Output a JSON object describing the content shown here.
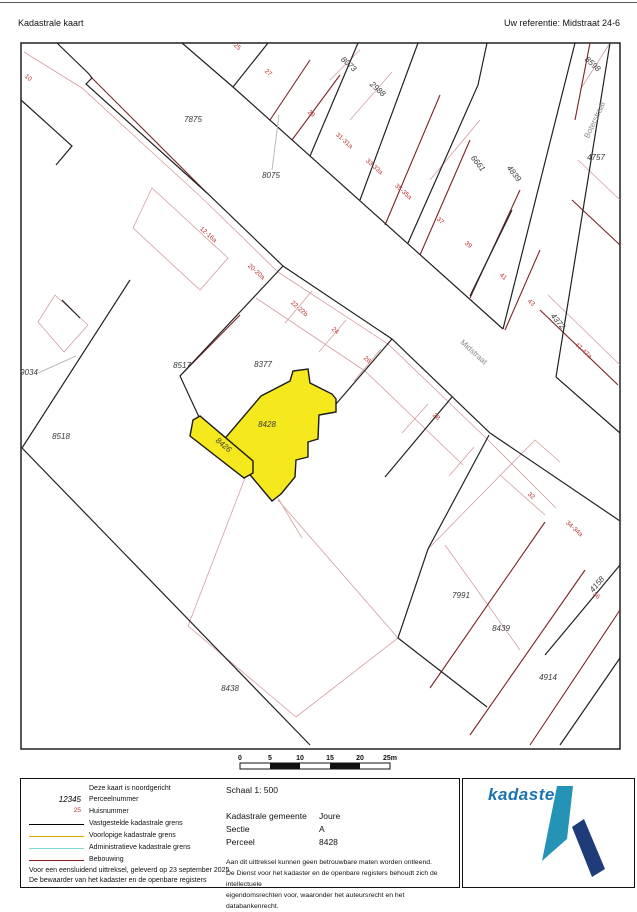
{
  "header": {
    "title": "Kadastrale kaart",
    "reference": "Uw referentie: Midstraat 24-6"
  },
  "map": {
    "highlight_color": "#f5e81c",
    "highlighted_parcel": "8428",
    "parcel_numbers": [
      {
        "t": "7875",
        "x": 193,
        "y": 122,
        "r": 0
      },
      {
        "t": "8075",
        "x": 271,
        "y": 178,
        "r": 0
      },
      {
        "t": "8073",
        "x": 347,
        "y": 66,
        "r": 42
      },
      {
        "t": "2988",
        "x": 376,
        "y": 91,
        "r": 42
      },
      {
        "t": "6661",
        "x": 476,
        "y": 165,
        "r": 52
      },
      {
        "t": "4839",
        "x": 512,
        "y": 175,
        "r": 52
      },
      {
        "t": "8598",
        "x": 591,
        "y": 66,
        "r": 42
      },
      {
        "t": "4757",
        "x": 596,
        "y": 160,
        "r": 0
      },
      {
        "t": "4372",
        "x": 556,
        "y": 323,
        "r": 50
      },
      {
        "t": "8517",
        "x": 182,
        "y": 368,
        "r": 0
      },
      {
        "t": "8377",
        "x": 263,
        "y": 367,
        "r": 0
      },
      {
        "t": "8428",
        "x": 267,
        "y": 427,
        "r": 0
      },
      {
        "t": "8426",
        "x": 222,
        "y": 447,
        "r": 40
      },
      {
        "t": "9034",
        "x": 29,
        "y": 375,
        "r": 0
      },
      {
        "t": "8518",
        "x": 61,
        "y": 439,
        "r": 0
      },
      {
        "t": "7991",
        "x": 461,
        "y": 598,
        "r": 0
      },
      {
        "t": "8439",
        "x": 501,
        "y": 631,
        "r": 0
      },
      {
        "t": "4914",
        "x": 548,
        "y": 680,
        "r": 0
      },
      {
        "t": "4158",
        "x": 599,
        "y": 586,
        "r": -50
      },
      {
        "t": "8438",
        "x": 230,
        "y": 691,
        "r": 0
      }
    ],
    "house_numbers": [
      {
        "t": "10",
        "x": 27,
        "y": 79,
        "r": 42
      },
      {
        "t": "25",
        "x": 236,
        "y": 48,
        "r": 42
      },
      {
        "t": "27",
        "x": 267,
        "y": 74,
        "r": 42
      },
      {
        "t": "29",
        "x": 310,
        "y": 115,
        "r": 42
      },
      {
        "t": "31-31a",
        "x": 343,
        "y": 142,
        "r": 42
      },
      {
        "t": "33-33a",
        "x": 373,
        "y": 168,
        "r": 42
      },
      {
        "t": "35-35a",
        "x": 402,
        "y": 193,
        "r": 42
      },
      {
        "t": "37",
        "x": 439,
        "y": 222,
        "r": 42
      },
      {
        "t": "39",
        "x": 467,
        "y": 246,
        "r": 42
      },
      {
        "t": "41",
        "x": 502,
        "y": 278,
        "r": 42
      },
      {
        "t": "43",
        "x": 530,
        "y": 304,
        "r": 42
      },
      {
        "t": "47-47a",
        "x": 582,
        "y": 352,
        "r": 42
      },
      {
        "t": "12-16a",
        "x": 207,
        "y": 236,
        "r": 42
      },
      {
        "t": "20-20a",
        "x": 255,
        "y": 273,
        "r": 42
      },
      {
        "t": "22-22b",
        "x": 298,
        "y": 310,
        "r": 42
      },
      {
        "t": "24",
        "x": 334,
        "y": 332,
        "r": 42
      },
      {
        "t": "26",
        "x": 366,
        "y": 361,
        "r": 42
      },
      {
        "t": "28",
        "x": 435,
        "y": 418,
        "r": 42
      },
      {
        "t": "32",
        "x": 530,
        "y": 497,
        "r": 42
      },
      {
        "t": "34-34a",
        "x": 573,
        "y": 530,
        "r": 42
      },
      {
        "t": "36",
        "x": 595,
        "y": 597,
        "r": 42
      }
    ],
    "street_names": [
      {
        "t": "Midstraat",
        "x": 472,
        "y": 354,
        "r": 42
      },
      {
        "t": "Boterstraat",
        "x": 597,
        "y": 121,
        "r": -65
      }
    ]
  },
  "scale_bar": {
    "ticks": [
      "0",
      "5",
      "10",
      "15",
      "20",
      "25m"
    ]
  },
  "legend": {
    "north_note": "Deze kaart is noordgericht",
    "items": [
      {
        "sym": "12345",
        "symtype": "italic",
        "color": "",
        "label": "Perceelnummer"
      },
      {
        "sym": "25",
        "symtype": "red",
        "color": "",
        "label": "Huisnummer"
      },
      {
        "sym": "",
        "symtype": "line",
        "color": "#000000",
        "label": "Vastgestelde kadastrale grens"
      },
      {
        "sym": "",
        "symtype": "line",
        "color": "#d8a800",
        "label": "Voorlopige kadastrale grens"
      },
      {
        "sym": "",
        "symtype": "line",
        "color": "#7fd4d4",
        "label": "Administratieve kadastrale grens"
      },
      {
        "sym": "",
        "symtype": "line",
        "color": "#8b1f1f",
        "label": "Bebouwing"
      }
    ],
    "note1": "Voor een eensluidend uittreksel, geleverd op 23 september 2025",
    "note2": "De bewaarder van het kadaster en de openbare registers"
  },
  "details": {
    "schaal": "Schaal 1: 500",
    "rows": [
      {
        "k": "Kadastrale gemeente",
        "v": "Joure"
      },
      {
        "k": "Sectie",
        "v": "A"
      },
      {
        "k": "Perceel",
        "v": "8428"
      }
    ],
    "disclaimer": [
      "Aan dit uittreksel kunnen geen betrouwbare maten worden ontleend.",
      "De Dienst voor het kadaster en de openbare registers behoudt zich de intellectuele",
      "eigendomsrechten voor, waaronder het auteursrecht en het databankenrecht."
    ]
  },
  "logo": {
    "text": "kadaster",
    "text_color": "#1b73b4",
    "teal": "#2593b5",
    "navy": "#1d3c78"
  }
}
